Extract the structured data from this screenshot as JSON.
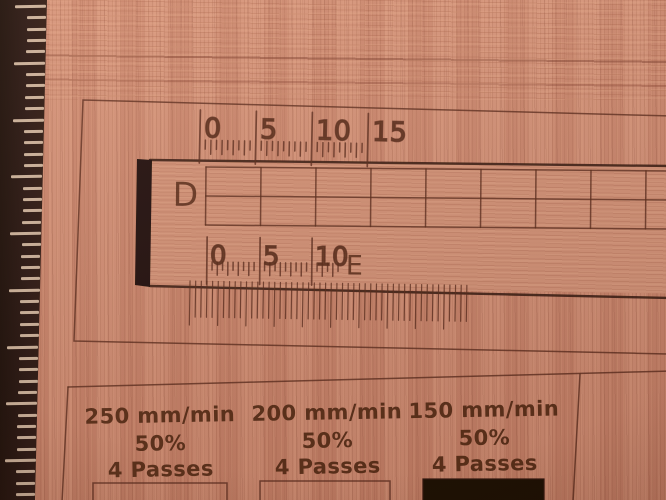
{
  "board": {
    "row_labels": {
      "top": "D",
      "bottom": "E"
    },
    "top_scale_labels": [
      "0",
      "5",
      "10",
      "15"
    ],
    "e_scale_labels": [
      "0",
      "5",
      "10"
    ]
  },
  "test_grid": {
    "columns": [
      {
        "speed": "250 mm/min",
        "power": "50%",
        "passes": "4 Passes"
      },
      {
        "speed": "200 mm/min",
        "power": "50%",
        "passes": "4 Passes"
      },
      {
        "speed": "150 mm/min",
        "power": "50%",
        "passes": "4 Passes"
      }
    ]
  },
  "colors": {
    "wood_base": "#cd8a72",
    "wood_light": "#e0a183",
    "wood_dark": "#a96a50",
    "engrave_line": "#54291a",
    "engrave_text": "#4a2212",
    "cut_edge": "#30150c",
    "slot_fill": "#1b0c07",
    "ruler_body": "#201008",
    "ruler_tick": "#d8c0a8"
  }
}
